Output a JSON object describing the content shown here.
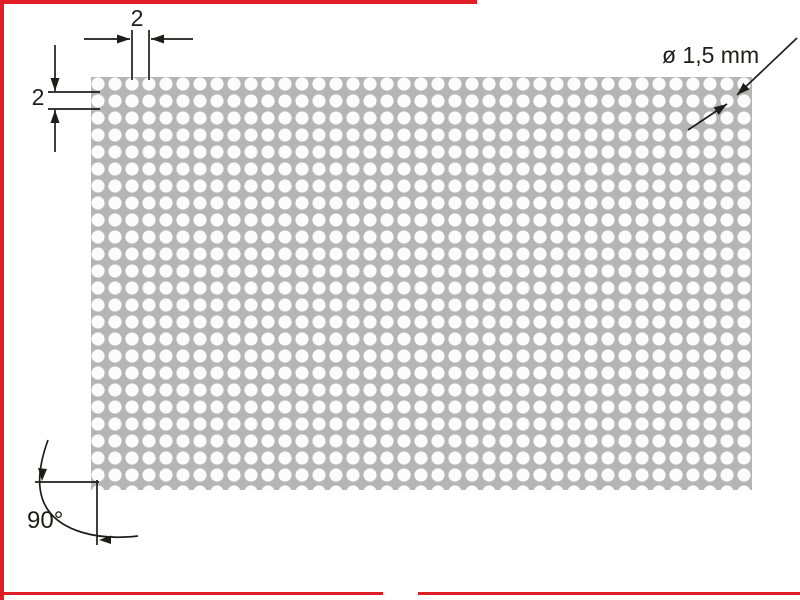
{
  "diagram": {
    "labels": {
      "pitch_horizontal": "2",
      "pitch_vertical": "2",
      "hole_diameter": "ø 1,5 mm",
      "corner_angle": "90°"
    },
    "colors": {
      "frame_red": "#e01e25",
      "sheet_gray": "#b5b5b5",
      "hole_white": "#fcfcfc",
      "line_black": "#1d1d1b"
    }
  }
}
